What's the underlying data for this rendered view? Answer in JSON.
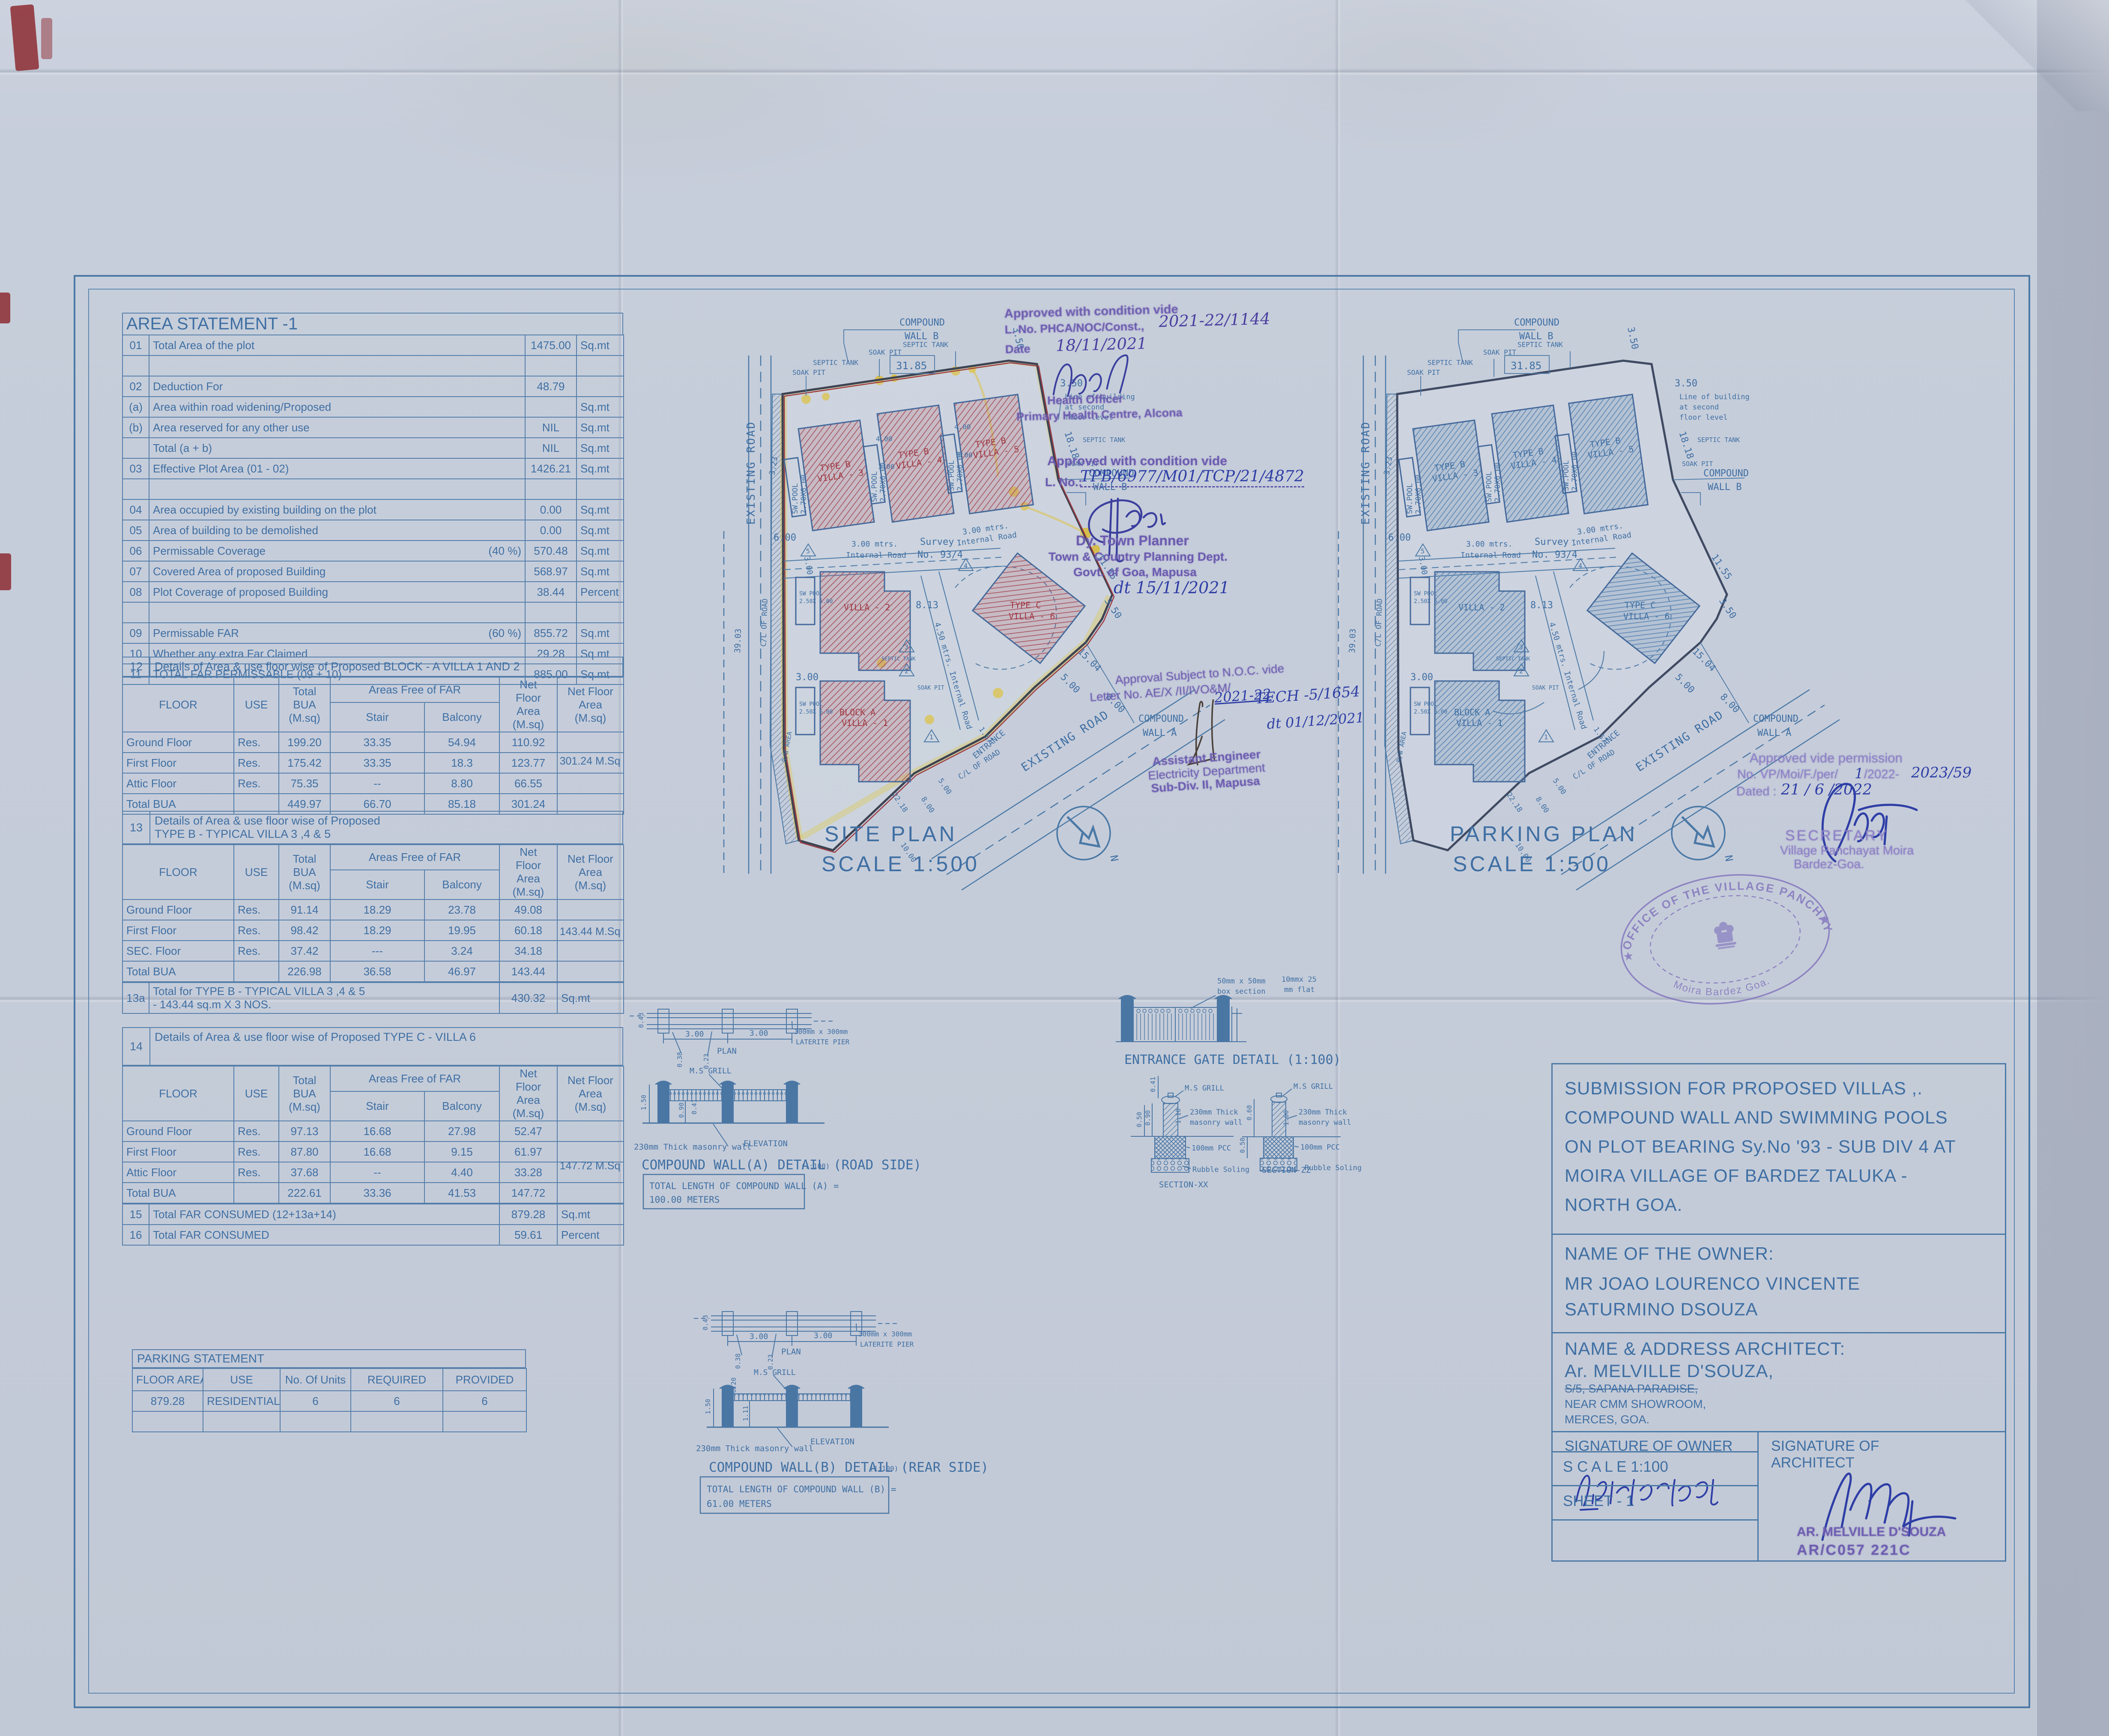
{
  "colors": {
    "line": "#4b79a6",
    "text": "#3f6fa3",
    "stamp_purple": "#6c5cb0",
    "ink_blue": "#2e3ea6",
    "villa_red": "#a5505b",
    "highlight_yellow": "#d6c23e",
    "paper": "#c5ccd9"
  },
  "area_statement": {
    "title": "AREA STATEMENT -1",
    "rows": [
      {
        "no": "01",
        "label": "Total Area of the plot",
        "pct": "",
        "value": "1475.00",
        "unit": "Sq.mt"
      },
      {
        "no": "",
        "label": "",
        "pct": "",
        "value": "",
        "unit": ""
      },
      {
        "no": "02",
        "label": "Deduction For",
        "pct": "",
        "value": "48.79",
        "unit": ""
      },
      {
        "no": "(a)",
        "label": "Area within road widening/Proposed",
        "pct": "",
        "value": "",
        "unit": "Sq.mt"
      },
      {
        "no": "(b)",
        "label": "Area reserved for any other use",
        "pct": "",
        "value": "NIL",
        "unit": "Sq.mt"
      },
      {
        "no": "",
        "label": "Total  (a + b)",
        "pct": "",
        "value": "NIL",
        "unit": "Sq.mt"
      },
      {
        "no": "03",
        "label": "Effective Plot Area (01 - 02)",
        "pct": "",
        "value": "1426.21",
        "unit": "Sq.mt"
      },
      {
        "no": "",
        "label": "",
        "pct": "",
        "value": "",
        "unit": ""
      },
      {
        "no": "04",
        "label": "Area occupied by existing building on the plot",
        "pct": "",
        "value": "0.00",
        "unit": "Sq.mt"
      },
      {
        "no": "05",
        "label": "Area of building to be demolished",
        "pct": "",
        "value": "0.00",
        "unit": "Sq.mt"
      },
      {
        "no": "06",
        "label": "Permissable Coverage",
        "pct": "(40 %)",
        "value": "570.48",
        "unit": "Sq.mt"
      },
      {
        "no": "07",
        "label": "Covered Area of proposed Building",
        "pct": "",
        "value": "568.97",
        "unit": "Sq.mt"
      },
      {
        "no": "08",
        "label": "Plot Coverage of  proposed Building",
        "pct": "",
        "value": "38.44",
        "unit": "Percent"
      },
      {
        "no": "",
        "label": "",
        "pct": "",
        "value": "",
        "unit": ""
      },
      {
        "no": "09",
        "label": "Permissable FAR",
        "pct": "(60 %)",
        "value": "855.72",
        "unit": "Sq.mt"
      },
      {
        "no": "10",
        "label": "Whether any extra Far Claimed",
        "pct": "",
        "value": "29.28",
        "unit": "Sq.mt"
      },
      {
        "no": "11",
        "label": "TOTAL FAR PERMISSABLE (09 + 10)",
        "pct": "",
        "value": "885.00",
        "unit": "Sq.mt"
      }
    ]
  },
  "floor_header": {
    "floor": "FLOOR",
    "use": "USE",
    "bua": "Total\nBUA\n(M.sq)",
    "free": "Areas Free of FAR",
    "stair": "Stair",
    "balcony": "Balcony",
    "net": "Net\nFloor Area\n(M.sq)",
    "nfa": "Net Floor Area\n(M.sq)"
  },
  "block12": {
    "no": "12",
    "title": "Details of Area & use floor wise of Proposed BLOCK  - A VILLA 1 AND 2",
    "rows": [
      {
        "floor": "Ground Floor",
        "use": "Res.",
        "bua": "199.20",
        "stair": "33.35",
        "balcony": "54.94",
        "net": "110.92",
        "nfa": ""
      },
      {
        "floor": "First Floor",
        "use": "Res.",
        "bua": "175.42",
        "stair": "33.35",
        "balcony": "18.3",
        "net": "123.77",
        "nfa": ""
      },
      {
        "floor": "Attic Floor",
        "use": "Res.",
        "bua": "75.35",
        "stair": "--",
        "balcony": "8.80",
        "net": "66.55",
        "nfa": ""
      },
      {
        "floor": "Total BUA",
        "use": "",
        "bua": "449.97",
        "stair": "66.70",
        "balcony": "85.18",
        "net": "301.24",
        "nfa": ""
      }
    ],
    "net_total": "301.24 M.Sq"
  },
  "block13": {
    "no": "13",
    "title": "Details of Area & use floor wise of Proposed\nTYPE B -  TYPICAL VILLA 3 ,4 & 5",
    "rows": [
      {
        "floor": "Ground Floor",
        "use": "Res.",
        "bua": "91.14",
        "stair": "18.29",
        "balcony": "23.78",
        "net": "49.08",
        "nfa": ""
      },
      {
        "floor": "First Floor",
        "use": "Res.",
        "bua": "98.42",
        "stair": "18.29",
        "balcony": "19.95",
        "net": "60.18",
        "nfa": ""
      },
      {
        "floor": "SEC. Floor",
        "use": "Res.",
        "bua": "37.42",
        "stair": "---",
        "balcony": "3.24",
        "net": "34.18",
        "nfa": ""
      },
      {
        "floor": "Total BUA",
        "use": "",
        "bua": "226.98",
        "stair": "36.58",
        "balcony": "46.97",
        "net": "143.44",
        "nfa": ""
      }
    ],
    "net_total": "143.44 M.Sq",
    "r13a": {
      "no": "13a",
      "label": "Total for TYPE B -  TYPICAL VILLA 3 ,4 & 5\n- 143.44 sq.m X 3 NOS.",
      "value": "430.32",
      "unit": "Sq.mt"
    }
  },
  "block14": {
    "no": "14",
    "title": "Details of Area & use floor wise of Proposed TYPE C - VILLA 6",
    "rows": [
      {
        "floor": "Ground Floor",
        "use": "Res.",
        "bua": "97.13",
        "stair": "16.68",
        "balcony": "27.98",
        "net": "52.47",
        "nfa": ""
      },
      {
        "floor": "First Floor",
        "use": "Res.",
        "bua": "87.80",
        "stair": "16.68",
        "balcony": "9.15",
        "net": "61.97",
        "nfa": ""
      },
      {
        "floor": "Attic Floor",
        "use": "Res.",
        "bua": "37.68",
        "stair": "--",
        "balcony": "4.40",
        "net": "33.28",
        "nfa": ""
      },
      {
        "floor": "Total BUA",
        "use": "",
        "bua": "222.61",
        "stair": "33.36",
        "balcony": "41.53",
        "net": "147.72",
        "nfa": ""
      }
    ],
    "net_total": "147.72 M.Sq"
  },
  "far_rows": [
    {
      "no": "15",
      "label": "Total FAR CONSUMED (12+13a+14)",
      "value": "879.28",
      "unit": "Sq.mt"
    },
    {
      "no": "16",
      "label": "Total FAR CONSUMED",
      "value": "59.61",
      "unit": "Percent"
    }
  ],
  "parking_statement": {
    "title": "PARKING STATEMENT",
    "headers": {
      "area": "FLOOR AREA",
      "use": "USE",
      "units": "No. Of Units",
      "req": "REQUIRED",
      "prov": "PROVIDED"
    },
    "rows": [
      {
        "area": "879.28",
        "use": "RESIDENTIAL",
        "units": "6",
        "req": "6",
        "prov": "6"
      },
      {
        "area": "",
        "use": "",
        "units": "",
        "req": "",
        "prov": ""
      }
    ]
  },
  "plans": {
    "site_title": "SITE PLAN",
    "parking_title": "PARKING PLAN",
    "scale": "SCALE 1:500",
    "labels": {
      "compound": "COMPOUND",
      "wall_a": "WALL A",
      "wall_b": "WALL B",
      "existing_road": "EXISTING ROAD",
      "cl_road": "C/L OF ROAD",
      "entrance": "ENTRANCE",
      "survey1": "Survey",
      "survey2": "No. 93/4",
      "road3a": "3.00 mtrs.",
      "road3b": "Internal Road",
      "road45": "4.50 mtrs. Internal Road",
      "soak": "SOAK PIT",
      "septic": "SEPTIC TANK",
      "rw": "R/W AREA",
      "lob1": "Line of building",
      "lob2": "at second",
      "lob3": "floor level",
      "pool": "SW.POOL",
      "pool_size": "2.70X6.00",
      "pool2": "SW POOL",
      "pool2_size": "2.50X 6.00",
      "north": "N"
    },
    "villas": {
      "v3a": "TYPE B",
      "v3b": "VILLA - 3",
      "v4a": "TYPE B",
      "v4b": "VILLA - 4",
      "v5a": "TYPE B",
      "v5b": "VILLA - 5",
      "v2": "VILLA - 2",
      "v1a": "BLOCK A",
      "v1b": "VILLA - 1",
      "v6a": "TYPE C",
      "v6b": "VILLA - 6"
    },
    "dims": {
      "d3185": "31.85",
      "d350": "3.50",
      "d1818": "18.18",
      "d1155": "11.55",
      "d1504": "15.04",
      "d500": "5.00",
      "d800": "8.00",
      "d600": "6.00",
      "d300": "3.00",
      "d400": "4.00",
      "d3903": "39.03",
      "d323": "3.23",
      "d813": "8.13",
      "d157": "1.57",
      "d2218": "22.18",
      "d1000": "10.00"
    }
  },
  "details": {
    "wall_a": {
      "plan": "PLAN",
      "d300": "3.00",
      "d043": "0.43",
      "d038": "0.38",
      "d023": "0.23",
      "pier1": "300mm x 300mm",
      "pier2": "LATERITE PIER",
      "grill": "M.S GRILL",
      "d150": "1.50",
      "d090": "0.90",
      "d041": "0.41",
      "masonry": "230mm Thick masonry wall",
      "elev": "ELEVATION",
      "title": "COMPOUND WALL(A) DETAIL (ROAD SIDE)",
      "scale": "(1:100)",
      "len1": "TOTAL LENGTH OF COMPOUND WALL (A) =",
      "len2": "100.00 METERS"
    },
    "wall_b": {
      "plan": "PLAN",
      "d300": "3.00",
      "d043": "0.43",
      "d038": "0.38",
      "d023": "0.23",
      "d020": "0.20",
      "pier1": "300mm x 300mm",
      "pier2": "LATERITE PIER",
      "grill": "M.S GRILL",
      "d150": "1.50",
      "d111": "1.11",
      "masonry": "230mm Thick masonry wall",
      "elev": "ELEVATION",
      "title": "COMPOUND WALL(B) DETAIL (REAR SIDE)",
      "scale": "(1:100)",
      "len1": "TOTAL LENGTH OF COMPOUND WALL (B) =",
      "len2": "61.00 METERS"
    },
    "gate": {
      "box1": "50mm x 50mm",
      "box2": "box section",
      "flat1": "10mmx 25",
      "flat2": "mm flat",
      "title": "ENTRANCE GATE DETAIL (1:100)"
    },
    "sxx": {
      "d041": "0.41",
      "d050": "0.50",
      "d090": "0.90",
      "d110": "1.10",
      "grill": "M.S GRILL",
      "m1": "230mm Thick",
      "m2": "masonry wall",
      "pcc": "100mm PCC",
      "rubble": "Rubble Soling",
      "name": "SECTION-XX"
    },
    "szz": {
      "d060": "0.60",
      "d050": "0.50",
      "d100": "1.00",
      "grill": "M.S GRILL",
      "m1": "230mm Thick",
      "m2": "masonry wall",
      "pcc": "100mm PCC",
      "rubble": "Rubble Soling",
      "name": "SECTION-ZZ"
    }
  },
  "stamps": {
    "health": {
      "l1": "Approved with condition vide",
      "l2": "L. No. PHCA/NOC/Const.,",
      "l2hw": "2021-22/1144",
      "l3": "Date",
      "l3hw": "18/11/2021",
      "l4": "Health Officer",
      "l5": "Primary Health Centre, Alcona"
    },
    "tcp": {
      "l1": "Approved with condition vide",
      "l2": "L. No.:",
      "l2hw": "TPB/6977/M01/TCP/21/4872",
      "l3": "Dy. Town Planner",
      "l4": "Town & Country Planning Dept.",
      "l5": "Govt. of Goa, Mapusa",
      "l6hw": "dt 15/11/2021"
    },
    "elec": {
      "l1": "Approval Subject to N.O.C. vide",
      "l2": "Letter No. AE/X /II/IVO&M/",
      "l2hw": "2021-22",
      "l2bhw": "TECH -5/1654",
      "l3hw": "dt 01/12/2021",
      "l4": "Assistant Engineer",
      "l5": "Electricity Department",
      "l6": "Sub-Div. II, Mapusa"
    },
    "vp": {
      "l1": "Approved vide permission",
      "l2": "No. VP/Moi/F./per/",
      "l2hw": "1",
      "l2b": "/2022-",
      "l2bhw": "2023/59",
      "l3": "Dated :",
      "l3hw": "21 / 6 /2022",
      "l4": "SECRETARY",
      "l5": "Village Panchayat Moira",
      "l6": "Bardez-Goa."
    },
    "round": {
      "top": "OFFICE OF THE VILLAGE PANCHAYAT",
      "bottom": "Moira Bardez Goa."
    }
  },
  "title_block": {
    "submission": [
      "SUBMISSION FOR PROPOSED VILLAS ,.",
      "COMPOUND WALL AND SWIMMING POOLS",
      "ON PLOT BEARING Sy.No '93 - SUB DIV 4 AT",
      "MOIRA VILLAGE OF BARDEZ TALUKA -",
      "NORTH GOA."
    ],
    "owner_label": "NAME OF THE OWNER:",
    "owner": [
      "MR JOAO LOURENCO VINCENTE",
      "SATURMINO DSOUZA"
    ],
    "arch_label": "NAME & ADDRESS ARCHITECT:",
    "arch_name": "Ar. MELVILLE D'SOUZA,",
    "arch_addr": [
      "S/5, SAPANA PARADISE,",
      "NEAR CMM SHOWROOM,",
      "MERCES, GOA."
    ],
    "sig_owner": "SIGNATURE OF OWNER",
    "sig_arch": "SIGNATURE OF\nARCHITECT",
    "scale": "S C A L E 1:100",
    "sheet": "SHEET - 1",
    "stamp_name": "AR. MELVILLE D'SOUZA",
    "stamp_no": "AR/C057 221C"
  }
}
